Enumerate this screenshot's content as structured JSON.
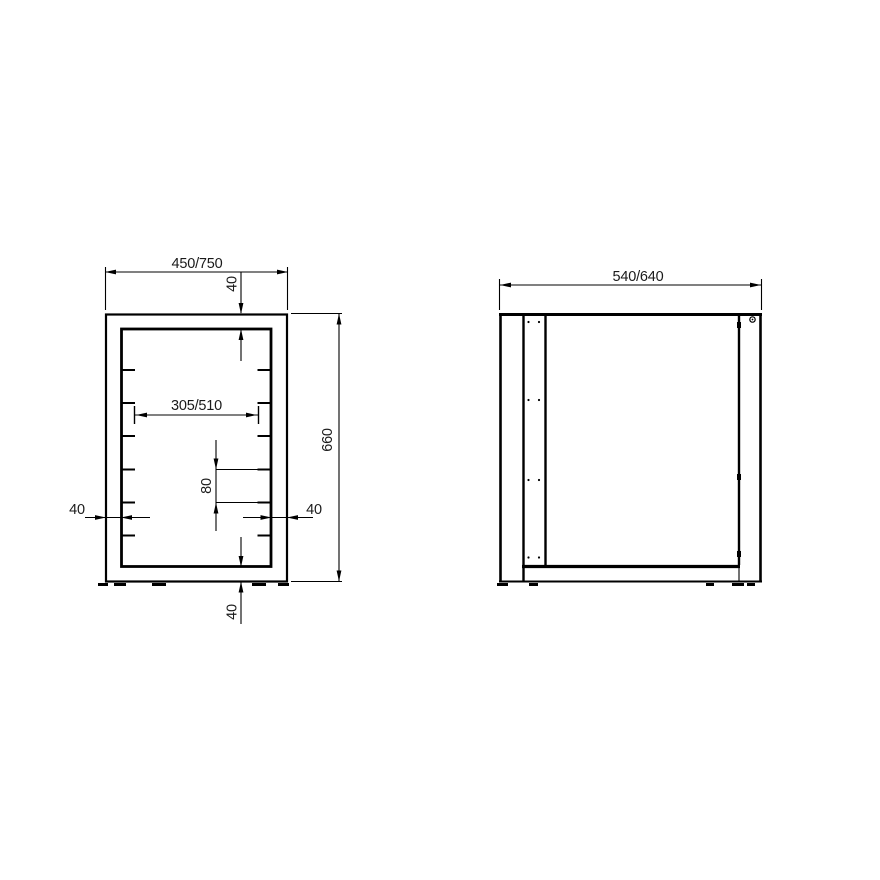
{
  "meta": {
    "title": "Frame technical drawing, two orthographic views",
    "background": "#ffffff",
    "line_color": "#000000",
    "text_color": "#1a1a1a"
  },
  "views": {
    "front": {
      "name": "front-view",
      "slot_ticks_per_side": 6,
      "dimensions": {
        "overall_width": "450/750",
        "top_rail": "40",
        "clear_width": "305/510",
        "slot_pitch": "80",
        "left_post": "40",
        "right_post": "40",
        "overall_height": "660",
        "bottom_rail": "40"
      }
    },
    "side": {
      "name": "side-view",
      "dimensions": {
        "overall_depth": "540/640"
      }
    }
  }
}
